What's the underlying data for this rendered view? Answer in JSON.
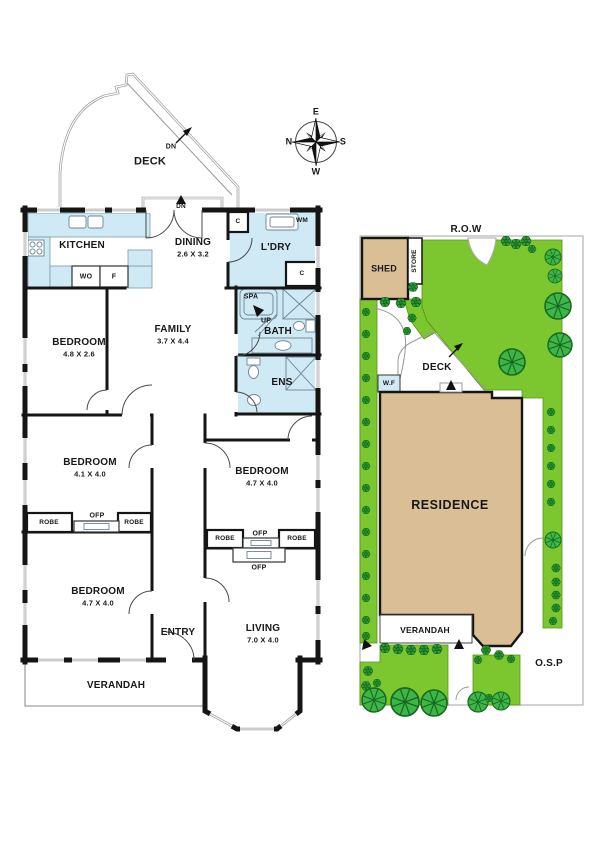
{
  "floorplan": {
    "rooms": {
      "deck": "DECK",
      "kitchen": "KITCHEN",
      "dining": "DINING",
      "laundry": "L'DRY",
      "family": "FAMILY",
      "bath": "BATH",
      "ens": "ENS",
      "entry": "ENTRY",
      "living": "LIVING",
      "verandah": "VERANDAH",
      "bedroom1": "BEDROOM",
      "bedroom2": "BEDROOM",
      "bedroom3": "BEDROOM",
      "bedroom4": "BEDROOM"
    },
    "dims": {
      "dining": "2.6 X 3.2",
      "family": "3.7 X 4.4",
      "bedroom1": "4.8 X 2.6",
      "bedroom2": "4.1 X 4.0",
      "bedroom3": "4.7 X 4.0",
      "bedroom4": "4.7 X 4.0",
      "living": "7.0 X 4.0"
    },
    "fixtures": {
      "wo": "WO",
      "f": "F",
      "wm": "WM",
      "c": "C",
      "spa": "SPA",
      "up": "UP",
      "dn": "DN",
      "robe": "ROBE",
      "ofp": "OFP"
    }
  },
  "compass": {
    "n": "N",
    "e": "E",
    "s": "S",
    "w": "W"
  },
  "siteplan": {
    "row": "R.O.W",
    "shed": "SHED",
    "store": "STORE",
    "deck": "DECK",
    "wf": "W.F",
    "residence": "RESIDENCE",
    "verandah": "VERANDAH",
    "osp": "O.S.P"
  },
  "colors": {
    "wet_area": "#cfe9f5",
    "lawn": "#7cc72f",
    "tree": "#3db549",
    "shrub": "#2f9e38",
    "building": "#d9be96",
    "wall": "#151515"
  }
}
